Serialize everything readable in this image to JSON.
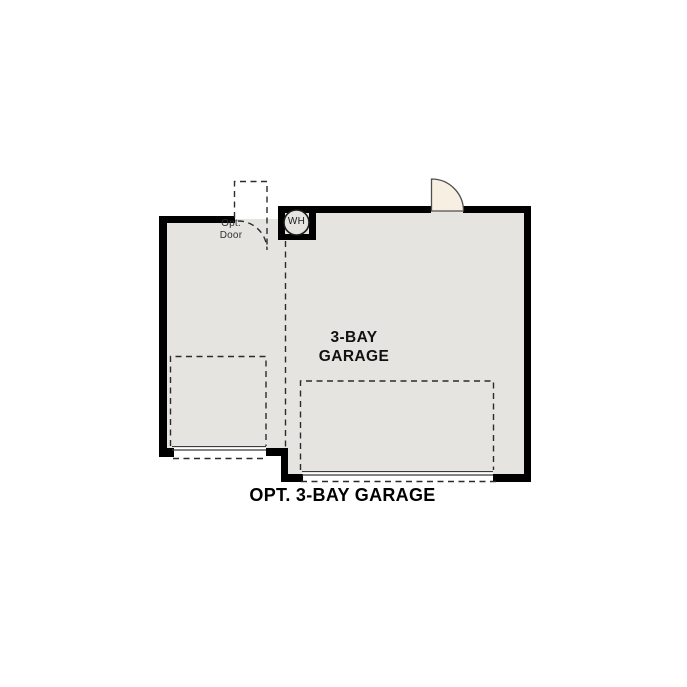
{
  "plan": {
    "caption": "OPT. 3-BAY GARAGE",
    "room": {
      "label_lines": [
        "3-BAY",
        "GARAGE"
      ]
    },
    "opt_door": {
      "label_lines": [
        "Opt.",
        "Door"
      ]
    },
    "water_heater": {
      "label": "WH"
    }
  },
  "icons": {
    "water_heater": "circle-with-WH-text",
    "entry_door": "quarter-circle-door-swing",
    "opt_door_swing": "dashed-quarter-arc"
  },
  "colors": {
    "wall": "#000000",
    "floor": "#e5e4e1",
    "door": "#f7efe1",
    "line": "#2b2b2b",
    "text": "#111111",
    "muted": "#2f2f2f"
  }
}
